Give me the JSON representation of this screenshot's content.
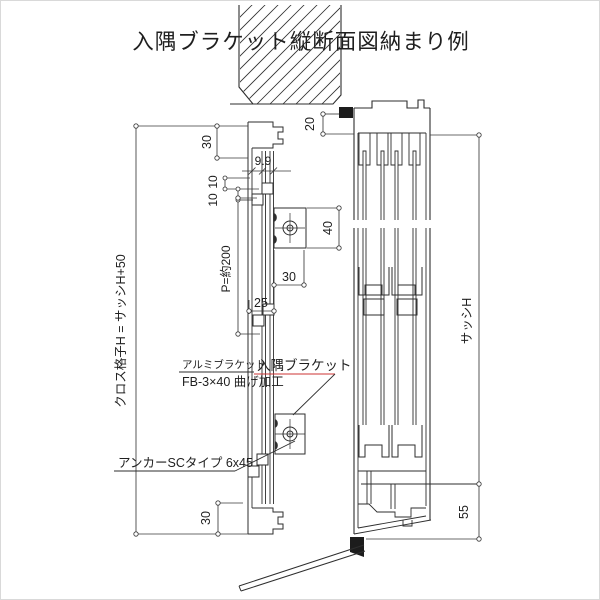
{
  "title": "入隅ブラケット縦断面図納まり例",
  "colors": {
    "line": "#2e2e2e",
    "dim_line": "#3a3a3a",
    "accent_red": "#cc3333",
    "background": "#ffffff"
  },
  "labels": {
    "lattice_height": "クロス格子H = サッシH+50",
    "sash_height": "サッシH",
    "pitch": "P=約200",
    "alumi_bracket": "アルミブラケット",
    "alumi_bracket_spec": "FB-3×40 曲げ加工",
    "corner_bracket": "入隅ブラケット",
    "anchor": "アンカーSCタイプ 6x45"
  },
  "dimensions": {
    "top_offset": "30",
    "web_gaps": "9.9",
    "offset_upper": "10",
    "offset_lower": "10",
    "top_clearance": "20",
    "bracket_height": "40",
    "bracket_width": "30",
    "plate_width": "25",
    "bottom_offset": "30",
    "sill_height": "55"
  }
}
